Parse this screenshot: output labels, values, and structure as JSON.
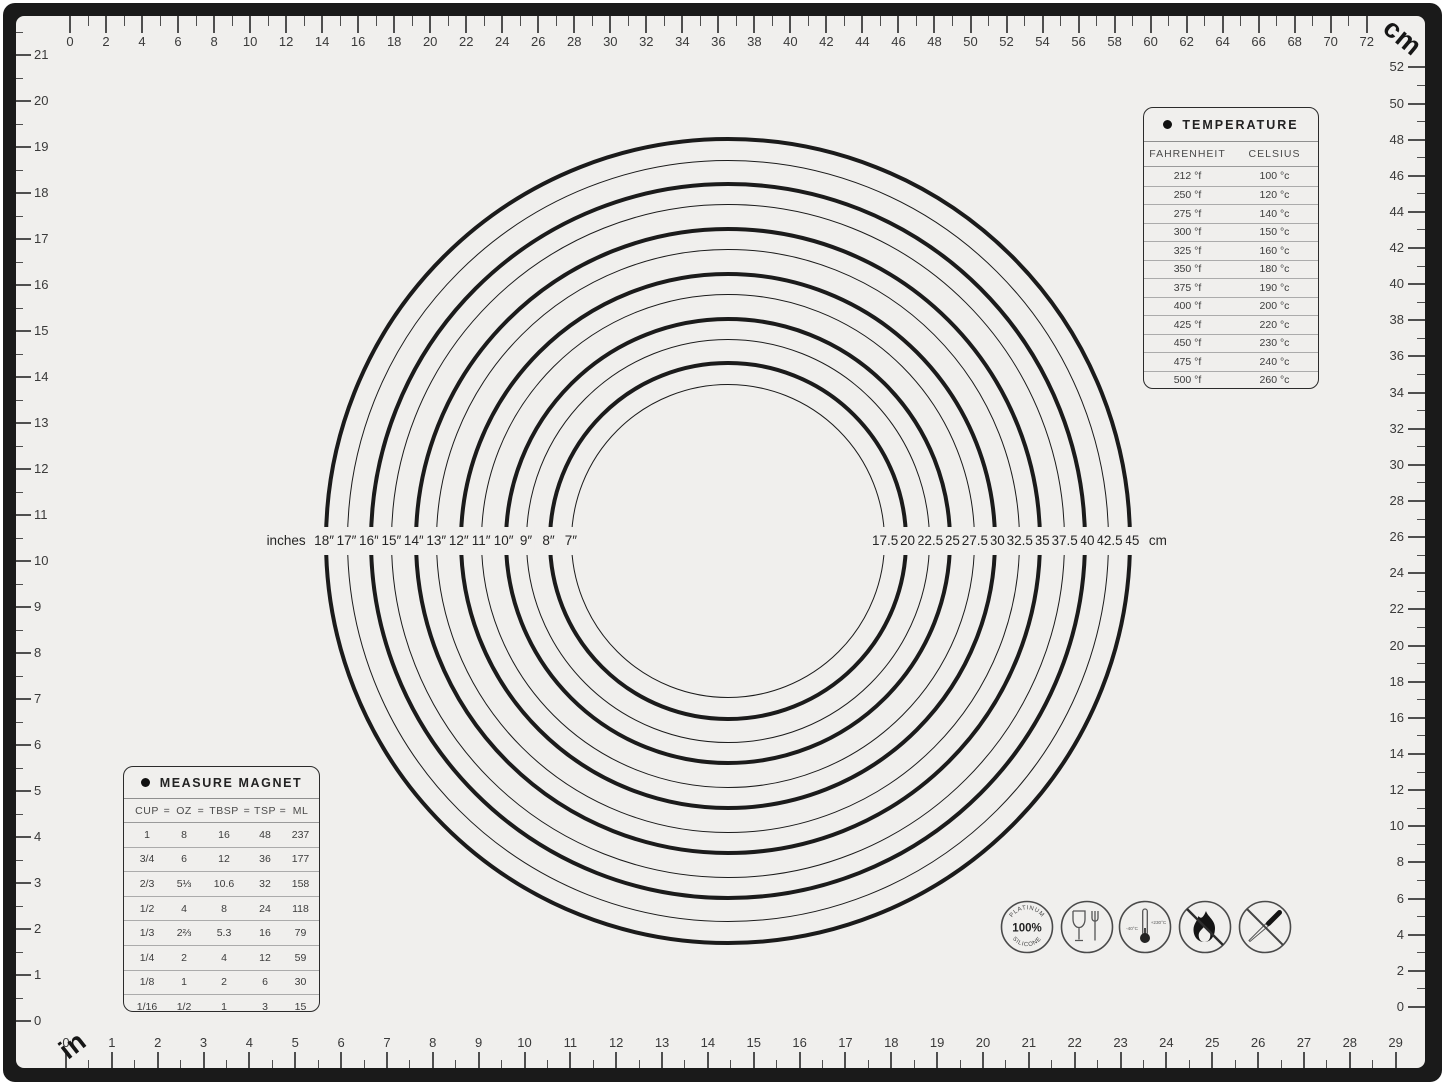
{
  "corner_labels": {
    "top_right": "cm",
    "bottom_left": "in"
  },
  "rulers": {
    "top": {
      "unit": "cm",
      "min": 0,
      "max": 72,
      "tick_step": 1,
      "number_step": 2
    },
    "right": {
      "unit": "cm",
      "min": 0,
      "max": 52,
      "tick_step": 1,
      "number_step": 2
    },
    "left": {
      "unit": "in",
      "min": 0,
      "max": 21,
      "tick_step": 0.5,
      "number_step": 1
    },
    "bottom": {
      "unit": "in",
      "min": 0,
      "max": 29,
      "tick_step": 0.5,
      "number_step": 1
    }
  },
  "circle_guide": {
    "left_axis_label": "inches",
    "right_axis_unit": "cm",
    "rings": [
      {
        "inches": 18,
        "inch_label": "18″",
        "cm_label": "45",
        "thick": true
      },
      {
        "inches": 17,
        "inch_label": "17″",
        "cm_label": "42.5",
        "thick": false
      },
      {
        "inches": 16,
        "inch_label": "16″",
        "cm_label": "40",
        "thick": true
      },
      {
        "inches": 15,
        "inch_label": "15″",
        "cm_label": "37.5",
        "thick": false
      },
      {
        "inches": 14,
        "inch_label": "14″",
        "cm_label": "35",
        "thick": true
      },
      {
        "inches": 13,
        "inch_label": "13″",
        "cm_label": "32.5",
        "thick": false
      },
      {
        "inches": 12,
        "inch_label": "12″",
        "cm_label": "30",
        "thick": true
      },
      {
        "inches": 11,
        "inch_label": "11″",
        "cm_label": "27.5",
        "thick": false
      },
      {
        "inches": 10,
        "inch_label": "10″",
        "cm_label": "25",
        "thick": true
      },
      {
        "inches": 9,
        "inch_label": "9″",
        "cm_label": "22.5",
        "thick": false
      },
      {
        "inches": 8,
        "inch_label": "8″",
        "cm_label": "20",
        "thick": true
      },
      {
        "inches": 7,
        "inch_label": "7″",
        "cm_label": "17.5",
        "thick": false
      }
    ]
  },
  "temperature_table": {
    "title": "TEMPERATURE",
    "col1": "FAHRENHEIT",
    "col2": "CELSIUS",
    "rows": [
      {
        "f": "212 °f",
        "c": "100 °c"
      },
      {
        "f": "250 °f",
        "c": "120 °c"
      },
      {
        "f": "275 °f",
        "c": "140 °c"
      },
      {
        "f": "300 °f",
        "c": "150 °c"
      },
      {
        "f": "325 °f",
        "c": "160 °c"
      },
      {
        "f": "350 °f",
        "c": "180 °c"
      },
      {
        "f": "375 °f",
        "c": "190 °c"
      },
      {
        "f": "400 °f",
        "c": "200 °c"
      },
      {
        "f": "425 °f",
        "c": "220 °c"
      },
      {
        "f": "450 °f",
        "c": "230 °c"
      },
      {
        "f": "475 °f",
        "c": "240 °c"
      },
      {
        "f": "500 °f",
        "c": "260 °c"
      }
    ]
  },
  "measure_table": {
    "title": "MEASURE MAGNET",
    "columns": [
      "CUP",
      "OZ",
      "TBSP",
      "TSP",
      "ML"
    ],
    "separator": "=",
    "rows": [
      [
        "1",
        "8",
        "16",
        "48",
        "237"
      ],
      [
        "3/4",
        "6",
        "12",
        "36",
        "177"
      ],
      [
        "2/3",
        "5⅓",
        "10.6",
        "32",
        "158"
      ],
      [
        "1/2",
        "4",
        "8",
        "24",
        "118"
      ],
      [
        "1/3",
        "2⅔",
        "5.3",
        "16",
        "79"
      ],
      [
        "1/4",
        "2",
        "4",
        "12",
        "59"
      ],
      [
        "1/8",
        "1",
        "2",
        "6",
        "30"
      ],
      [
        "1/16",
        "1/2",
        "1",
        "3",
        "15"
      ]
    ]
  },
  "icons": {
    "platinum": {
      "top": "PLATINUM",
      "center": "100%",
      "bottom": "SILICONE"
    },
    "thermometer": {
      "min": "-40°C",
      "max": "+230°C"
    }
  }
}
